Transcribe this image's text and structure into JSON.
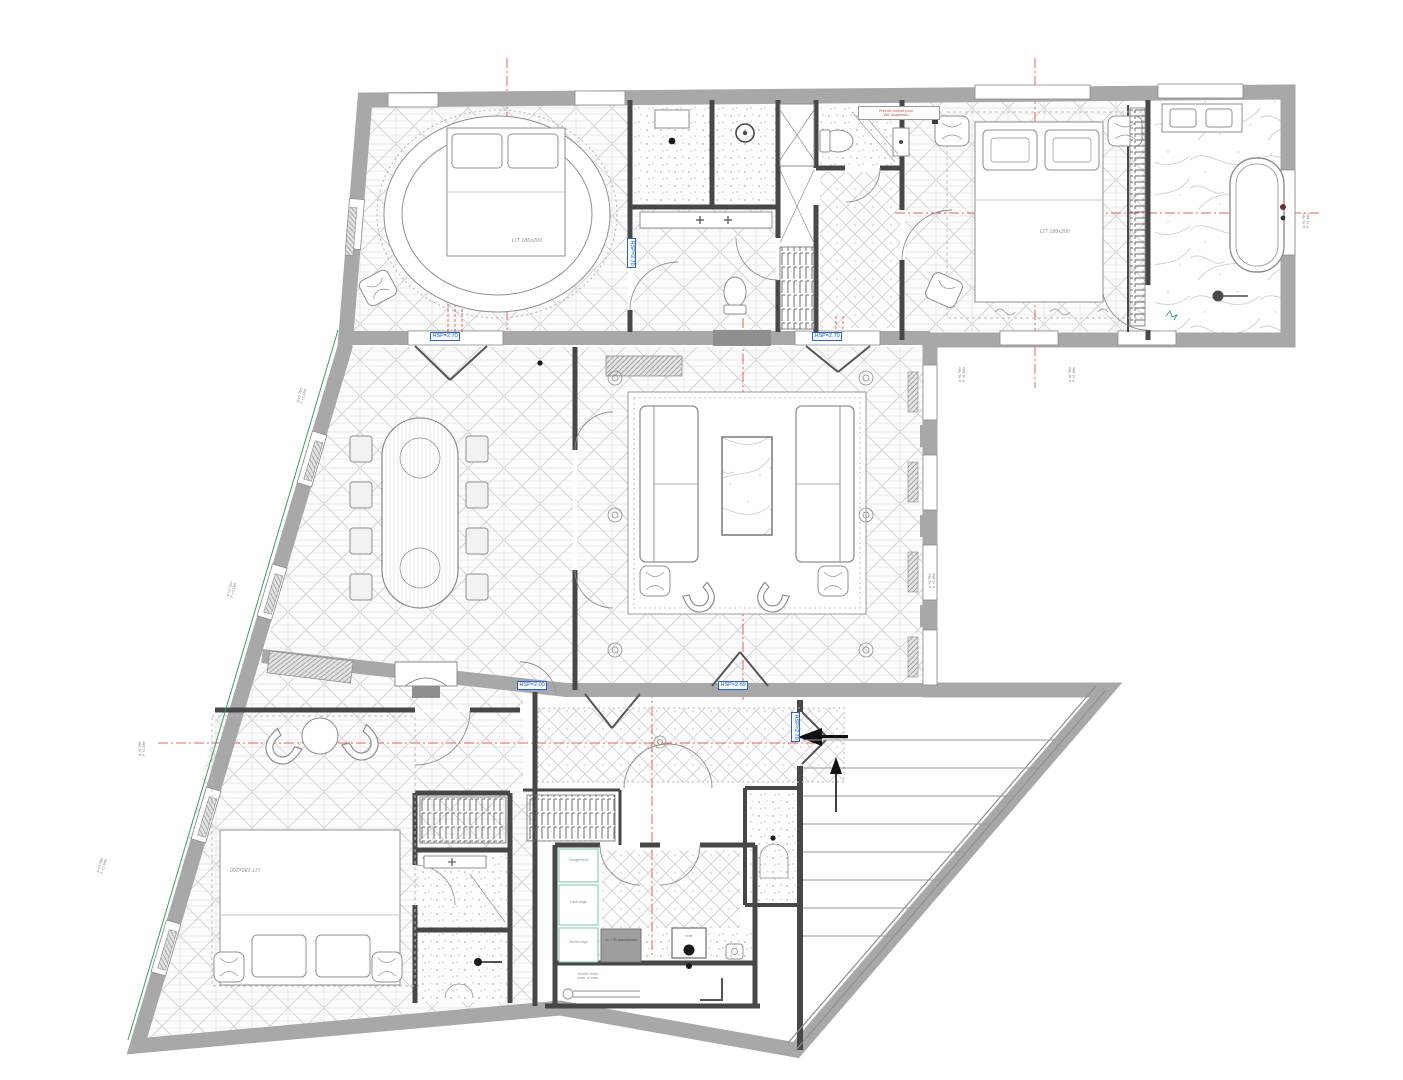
{
  "plan": {
    "bed_labels": {
      "bedroom_1": "LIT 180x200",
      "bedroom_2": "LIT 180x200",
      "bedroom_3": "LIT 180x200"
    },
    "ceiling_heights": {
      "dining_door": "HSP=2.70",
      "living_door": "HSP=2.70",
      "corridor": "HSP=2.70",
      "dining_low": "HSP=2.00",
      "living_low": "HSP=2.69",
      "entry": "HSP=2.70"
    },
    "red_note": {
      "line1": "Prévoir renfort pour",
      "line2": "WC suspendu"
    },
    "storage_labels": {
      "cab1": "Rangement",
      "cab2": "Lave-linge",
      "cab3": "Sèche-linge"
    },
    "tech_labels": {
      "washer": "LL + SL superposés",
      "sink": "évier",
      "annex1": "arrivée d'eau",
      "annex2": "évac. à créer"
    },
    "window_tags": [
      {
        "a": "A +0.79m",
        "f": "F +2.19m"
      },
      {
        "a": "A +0.79m",
        "f": "F +2.19m"
      },
      {
        "a": "A +0.79m",
        "f": "F +2.19m"
      },
      {
        "a": "A +0.79m",
        "f": "F +2.19m"
      },
      {
        "a": "A +0.79m",
        "f": "F +2.19m"
      },
      {
        "a": "A +0.79m",
        "f": "F +2.19m"
      },
      {
        "a": "A +0.79m",
        "f": "F +2.19m"
      },
      {
        "a": "A +0.79m",
        "f": "F +2.19m"
      }
    ],
    "colors": {
      "axis_red": "#e0483a",
      "label_blue": "#2e62c8",
      "wall_gray": "#a8a8a8",
      "partition_dark": "#474747",
      "property_green": "#3e9e63",
      "cabinet_teal": "#7bc4b2"
    }
  }
}
